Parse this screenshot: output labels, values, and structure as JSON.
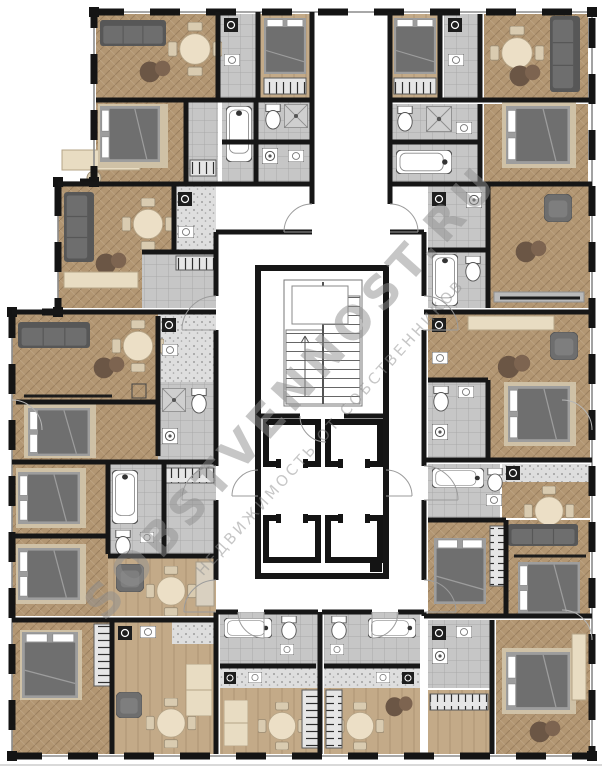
{
  "meta": {
    "kind": "architectural floor plan",
    "subject": "residential multi-apartment floor with central stair and elevator core"
  },
  "watermark": {
    "line1": "SOBSTVENNOST.RU",
    "line2": "НЕДВИЖИМОСТЬ ОТ СОБСТВЕННИКОВ"
  },
  "palette": {
    "background": "#ffffff",
    "wall": "#161616",
    "wood_floor": "#b29672",
    "wood_floor_light": "#c3aa88",
    "tile_floor": "#c6c6c6",
    "counter_speckle": "#dedede",
    "furniture_dark": "#6f6f6f",
    "furniture_frame": "#9d9d9d",
    "accent_beige": "#ecdfc6",
    "accent_brown": "#6b5645",
    "fixture_white": "#ffffff",
    "watermark_gray": "#8f8f8f"
  },
  "core": {
    "staircase": "double-flight staircase",
    "elevators": [
      "elevator-1",
      "elevator-2",
      "elevator-3",
      "elevator-4"
    ],
    "lobby": "elevator lobby",
    "corridors": [
      "top corridor",
      "left corridor",
      "right corridor",
      "lower vestibule"
    ]
  },
  "zones": [
    "apartment-top-left",
    "apartment-top-center-left",
    "apartment-top-right",
    "apartment-left-upper",
    "apartment-left-middle",
    "apartment-left-lower",
    "apartment-bottom-left",
    "studio-bottom-center-left",
    "studio-bottom-center-right",
    "apartment-bottom-right",
    "apartment-right-lower",
    "apartment-right-middle",
    "apartment-right-upper"
  ],
  "legend": {
    "elements": [
      "bed",
      "sofa",
      "armchair",
      "dining-table",
      "coffee-poufs",
      "wardrobe",
      "kitchen-counter",
      "stove",
      "sink",
      "bathtub",
      "shower",
      "toilet",
      "washing-machine",
      "door-swing",
      "window",
      "tv-console",
      "desk",
      "cabinet"
    ]
  }
}
